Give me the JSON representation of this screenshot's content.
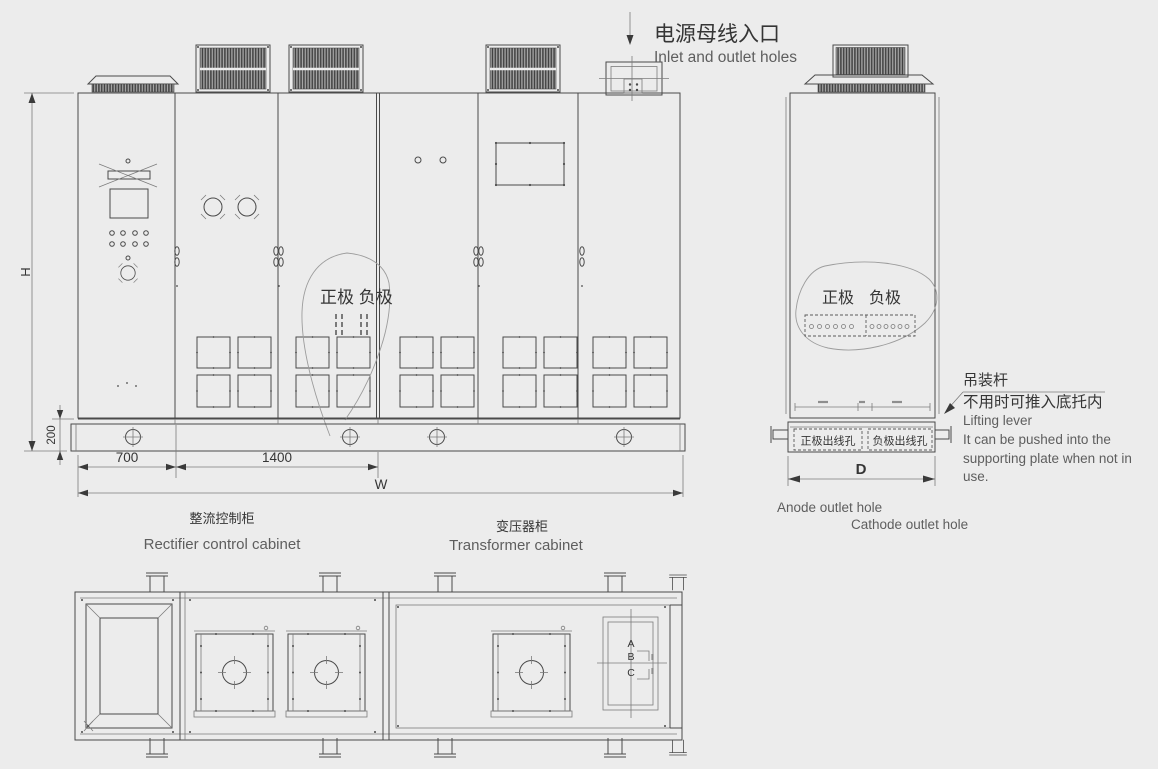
{
  "colors": {
    "background": "#ececec",
    "line": "#4a4a4a",
    "text": "#353535",
    "muted_text": "#5e5e5e",
    "vent_fill": "#8f8f8f"
  },
  "annotations": {
    "power_inlet": {
      "cn": "电源母线入口",
      "en": "Inlet and outlet holes"
    },
    "front": {
      "polarity": "正极 负极",
      "dim_h": "H",
      "dim_base": "200",
      "dim_left": "700",
      "dim_mid": "1400",
      "dim_w": "W",
      "rectifier_cn": "整流控制柜",
      "rectifier_en": "Rectifier control cabinet",
      "transformer_cn": "变压器柜",
      "transformer_en": "Transformer cabinet"
    },
    "side": {
      "anode": "正极",
      "cathode": "负极",
      "anode_hole": "正极出线孔",
      "cathode_hole": "负极出线孔",
      "dim_d": "D",
      "lever_cn": "吊装杆",
      "lever_note_cn": "不用时可推入底托内",
      "lever_en1": "Lifting lever",
      "lever_en2": "It can be pushed into the",
      "lever_en3": "supporting plate when not in",
      "lever_en4": "use.",
      "anode_hole_en": "Anode outlet hole",
      "cathode_hole_en": "Cathode outlet hole"
    },
    "plan": {
      "mark_a": "A",
      "mark_b": "B",
      "mark_c": "C"
    }
  }
}
